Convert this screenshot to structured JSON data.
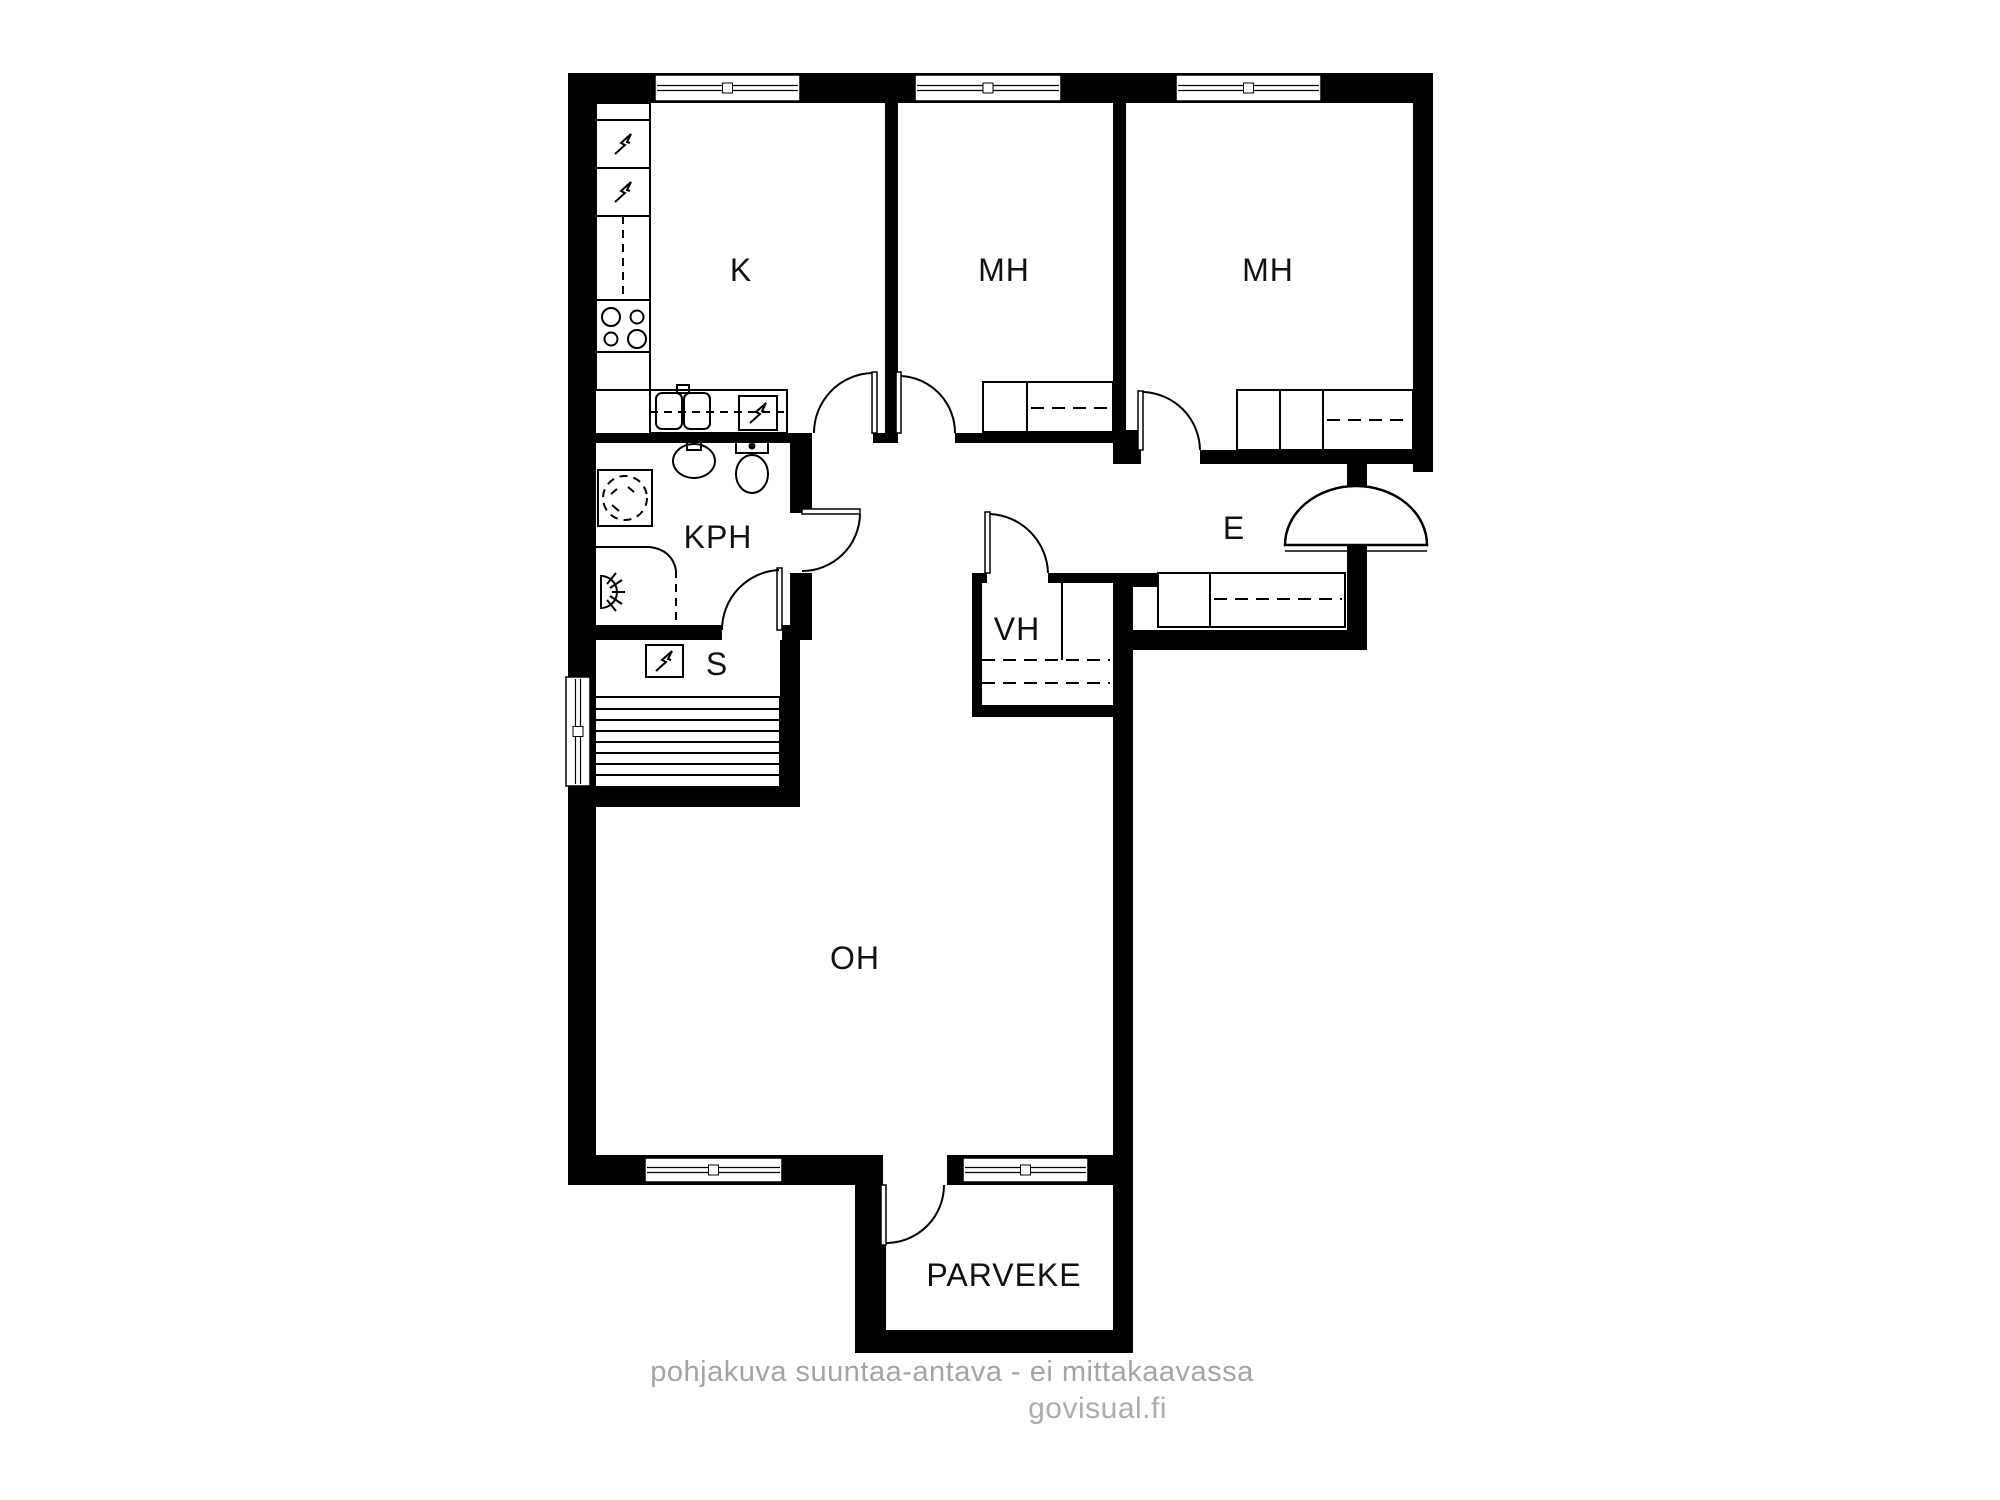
{
  "watermark": {
    "disclaimer": "pohjakuva suuntaa-antava - ei mittakaavassa",
    "credit": "govisual.fi"
  },
  "colors": {
    "background": "#ffffff",
    "wall": "#000000",
    "line": "#000000",
    "label": "#111111",
    "watermark": "#a6a6a6"
  },
  "room_labels": [
    {
      "id": "kitchen",
      "text": "K",
      "x": 741,
      "y": 270
    },
    {
      "id": "bedroom-1",
      "text": "MH",
      "x": 1004,
      "y": 270
    },
    {
      "id": "bedroom-2",
      "text": "MH",
      "x": 1268,
      "y": 270
    },
    {
      "id": "bathroom",
      "text": "KPH",
      "x": 718,
      "y": 537
    },
    {
      "id": "sauna",
      "text": "S",
      "x": 717,
      "y": 664
    },
    {
      "id": "closet",
      "text": "VH",
      "x": 1017,
      "y": 629
    },
    {
      "id": "entry",
      "text": "E",
      "x": 1234,
      "y": 528
    },
    {
      "id": "living-room",
      "text": "OH",
      "x": 855,
      "y": 958
    },
    {
      "id": "balcony",
      "text": "PARVEKE",
      "x": 1004,
      "y": 1275
    }
  ],
  "plan": {
    "walls": [
      {
        "n": "wall-top",
        "x": 568,
        "y": 73,
        "w": 865,
        "h": 30
      },
      {
        "n": "wall-left",
        "x": 568,
        "y": 73,
        "w": 28,
        "h": 1112
      },
      {
        "n": "wall-right-upper",
        "x": 1413,
        "y": 73,
        "w": 20,
        "h": 399
      },
      {
        "n": "wall-k-mh1",
        "x": 885,
        "y": 103,
        "w": 13,
        "h": 340
      },
      {
        "n": "wall-mh1-mh2",
        "x": 1113,
        "y": 103,
        "w": 13,
        "h": 330
      },
      {
        "n": "wall-mh1-mh2-base",
        "x": 1113,
        "y": 430,
        "w": 28,
        "h": 34
      },
      {
        "n": "wall-k-bottom",
        "x": 590,
        "y": 433,
        "w": 222,
        "h": 10
      },
      {
        "n": "wall-door-pier",
        "x": 873,
        "y": 433,
        "w": 25,
        "h": 10
      },
      {
        "n": "wall-mh1-bottom",
        "x": 955,
        "y": 433,
        "w": 158,
        "h": 10
      },
      {
        "n": "wall-mh2-bottom-left",
        "x": 1133,
        "y": 450,
        "w": 8,
        "h": 14
      },
      {
        "n": "wall-mh2-bottom",
        "x": 1200,
        "y": 450,
        "w": 213,
        "h": 14
      },
      {
        "n": "wall-entry-stub-upper",
        "x": 1347,
        "y": 464,
        "w": 20,
        "h": 23
      },
      {
        "n": "wall-entry-stub-lower",
        "x": 1347,
        "y": 549,
        "w": 20,
        "h": 101
      },
      {
        "n": "wall-entry-bottom",
        "x": 1133,
        "y": 630,
        "w": 234,
        "h": 20
      },
      {
        "n": "wall-entry-left-stub",
        "x": 1133,
        "y": 573,
        "w": 25,
        "h": 14
      },
      {
        "n": "wall-vh-top-left",
        "x": 972,
        "y": 573,
        "w": 15,
        "h": 10
      },
      {
        "n": "wall-vh-top-right",
        "x": 1048,
        "y": 573,
        "w": 85,
        "h": 10
      },
      {
        "n": "wall-vh-left",
        "x": 972,
        "y": 573,
        "w": 10,
        "h": 144
      },
      {
        "n": "wall-vh-bottom",
        "x": 972,
        "y": 705,
        "w": 161,
        "h": 12
      },
      {
        "n": "wall-oh-right",
        "x": 1113,
        "y": 573,
        "w": 20,
        "h": 780
      },
      {
        "n": "wall-kph-right-upper",
        "x": 790,
        "y": 443,
        "w": 22,
        "h": 70
      },
      {
        "n": "wall-kph-right-lower",
        "x": 790,
        "y": 573,
        "w": 22,
        "h": 67
      },
      {
        "n": "wall-kph-bottom-left",
        "x": 590,
        "y": 625,
        "w": 132,
        "h": 15
      },
      {
        "n": "wall-kph-bottom-right",
        "x": 782,
        "y": 625,
        "w": 30,
        "h": 15
      },
      {
        "n": "wall-sauna-right",
        "x": 780,
        "y": 640,
        "w": 20,
        "h": 147
      },
      {
        "n": "wall-sauna-bottom",
        "x": 568,
        "y": 787,
        "w": 232,
        "h": 20
      },
      {
        "n": "wall-oh-bottom",
        "x": 568,
        "y": 1155,
        "w": 565,
        "h": 30
      },
      {
        "n": "wall-balcony-left",
        "x": 855,
        "y": 1185,
        "w": 31,
        "h": 168
      },
      {
        "n": "wall-balcony-bottom",
        "x": 855,
        "y": 1330,
        "w": 278,
        "h": 23
      }
    ],
    "openings": [
      {
        "n": "balcony-door-opening",
        "x": 883,
        "y": 1155,
        "w": 64,
        "h": 31
      }
    ],
    "windows_h": [
      {
        "n": "window-kitchen",
        "x": 655,
        "y": 75,
        "w": 145,
        "h": 26
      },
      {
        "n": "window-bedroom-1",
        "x": 915,
        "y": 75,
        "w": 146,
        "h": 26
      },
      {
        "n": "window-bedroom-2",
        "x": 1176,
        "y": 75,
        "w": 145,
        "h": 26
      },
      {
        "n": "window-living-left",
        "x": 645,
        "y": 1158,
        "w": 137,
        "h": 24
      },
      {
        "n": "window-living-right",
        "x": 963,
        "y": 1158,
        "w": 125,
        "h": 24
      }
    ],
    "windows_v": [
      {
        "n": "window-sauna",
        "x": 566,
        "y": 677,
        "w": 24,
        "h": 109
      }
    ],
    "doors": [
      {
        "n": "door-kitchen",
        "leaf": [
          872,
          372,
          5,
          61
        ],
        "arc": "M 814 433 A 60 60 0 0 1 872 373"
      },
      {
        "n": "door-bedroom-1",
        "leaf": [
          896,
          372,
          5,
          61
        ],
        "arc": "M 955 433 A 57 57 0 0 0 901 376"
      },
      {
        "n": "door-bedroom-2",
        "leaf": [
          1138,
          391,
          5,
          59
        ],
        "arc": "M 1200 450 A 59 59 0 0 0 1143 392"
      },
      {
        "n": "door-bathroom",
        "leaf": [
          802,
          509,
          58,
          5
        ],
        "arc": "M 860 514 A 58 58 0 0 1 802 571"
      },
      {
        "n": "door-sauna",
        "leaf": [
          777,
          568,
          5,
          62
        ],
        "arc": "M 722 630 A 60 60 0 0 1 779 570"
      },
      {
        "n": "door-closet",
        "leaf": [
          985,
          512,
          5,
          61
        ],
        "arc": "M 1048 573 A 61 61 0 0 0 990 514"
      },
      {
        "n": "door-balcony",
        "leaf": [
          881,
          1185,
          5,
          60
        ],
        "arc": "M 944 1185 A 58 58 0 0 1 886 1243"
      }
    ],
    "entrance_door": {
      "n": "entrance-door",
      "dome": "M 1285 545 A 71 59 0 0 1 1427 545 Z",
      "threshold": [
        1285,
        551,
        1427,
        551
      ],
      "notch": [
        1347,
        545,
        20,
        7
      ]
    },
    "wardrobes": [
      {
        "n": "wardrobe-bedroom-1",
        "box": [
          983,
          382,
          130,
          50
        ],
        "lines": [
          [
            1027,
            382,
            1027,
            432
          ]
        ],
        "dashes": [
          [
            1031,
            408,
            1110,
            408
          ]
        ]
      },
      {
        "n": "wardrobe-bedroom-2",
        "box": [
          1237,
          390,
          176,
          60
        ],
        "lines": [
          [
            1280,
            390,
            1280,
            450
          ],
          [
            1323,
            390,
            1323,
            450
          ]
        ],
        "dashes": [
          [
            1327,
            420,
            1410,
            420
          ]
        ]
      },
      {
        "n": "wardrobe-entry",
        "box": [
          1158,
          573,
          187,
          54
        ],
        "lines": [
          [
            1210,
            573,
            1210,
            627
          ]
        ],
        "dashes": [
          [
            1214,
            599,
            1342,
            599
          ]
        ]
      },
      {
        "n": "shelves-closet",
        "box": null,
        "lines": [
          [
            1062,
            583,
            1062,
            660
          ]
        ],
        "dashes": [
          [
            982,
            660,
            1110,
            660
          ],
          [
            982,
            683,
            1110,
            683
          ]
        ]
      }
    ],
    "fixtures": [
      {
        "n": "kitchen-tall-unit",
        "t": "r",
        "x": 596,
        "y": 103,
        "w": 54,
        "h": 287
      },
      {
        "n": "kitchen-unit-line",
        "t": "l",
        "x1": 596,
        "y1": 120,
        "x2": 650,
        "y2": 120
      },
      {
        "n": "kitchen-unit-line",
        "t": "l",
        "x1": 596,
        "y1": 168,
        "x2": 650,
        "y2": 168
      },
      {
        "n": "kitchen-unit-line",
        "t": "l",
        "x1": 596,
        "y1": 216,
        "x2": 650,
        "y2": 216
      },
      {
        "n": "kitchen-unit-line",
        "t": "l",
        "x1": 596,
        "y1": 300,
        "x2": 650,
        "y2": 300
      },
      {
        "n": "kitchen-unit-line",
        "t": "l",
        "x1": 596,
        "y1": 352,
        "x2": 650,
        "y2": 352
      },
      {
        "n": "kitchen-cabinet-dash",
        "t": "l",
        "x1": 623,
        "y1": 216,
        "x2": 623,
        "y2": 300,
        "d": 1
      },
      {
        "n": "fridge-icon",
        "t": "b",
        "x": 623,
        "y": 144
      },
      {
        "n": "freezer-icon",
        "t": "b",
        "x": 623,
        "y": 192
      },
      {
        "n": "stove-burner",
        "t": "e",
        "cx": 611,
        "cy": 317,
        "rx": 9,
        "ry": 9
      },
      {
        "n": "stove-burner",
        "t": "e",
        "cx": 637,
        "cy": 317,
        "rx": 6.5,
        "ry": 6.5
      },
      {
        "n": "stove-burner",
        "t": "e",
        "cx": 611,
        "cy": 339,
        "rx": 6.5,
        "ry": 6.5
      },
      {
        "n": "stove-burner",
        "t": "e",
        "cx": 637,
        "cy": 339,
        "rx": 9,
        "ry": 9
      },
      {
        "n": "kitchen-counter",
        "t": "r",
        "x": 650,
        "y": 390,
        "w": 137,
        "h": 43
      },
      {
        "n": "kitchen-counter-dash",
        "t": "l",
        "x1": 650,
        "y1": 412,
        "x2": 787,
        "y2": 412,
        "d": 1
      },
      {
        "n": "sink-basin",
        "t": "r",
        "x": 656,
        "y": 393,
        "w": 26,
        "h": 36,
        "rx": 6
      },
      {
        "n": "sink-basin",
        "t": "r",
        "x": 684,
        "y": 393,
        "w": 26,
        "h": 36,
        "rx": 6
      },
      {
        "n": "sink-faucet",
        "t": "r",
        "x": 677,
        "y": 385,
        "w": 12,
        "h": 8
      },
      {
        "n": "dishwasher-box",
        "t": "r",
        "x": 739,
        "y": 396,
        "w": 38,
        "h": 34
      },
      {
        "n": "dishwasher-icon",
        "t": "b",
        "x": 758,
        "y": 413
      },
      {
        "n": "washing-machine-box",
        "t": "r",
        "x": 598,
        "y": 470,
        "w": 54,
        "h": 56
      },
      {
        "n": "washing-machine-circle",
        "t": "e",
        "cx": 625,
        "cy": 498,
        "rx": 22,
        "ry": 22,
        "d": 1
      },
      {
        "n": "washer-mark",
        "t": "l",
        "x1": 612,
        "y1": 505,
        "x2": 619,
        "y2": 511
      },
      {
        "n": "washer-mark",
        "t": "l",
        "x1": 628,
        "y1": 487,
        "x2": 634,
        "y2": 492
      },
      {
        "n": "washer-mark",
        "t": "l",
        "x1": 617,
        "y1": 489,
        "x2": 611,
        "y2": 494
      },
      {
        "n": "bathroom-sink",
        "t": "e",
        "cx": 694,
        "cy": 461,
        "rx": 21,
        "ry": 17
      },
      {
        "n": "bathroom-faucet",
        "t": "r",
        "x": 687,
        "y": 441,
        "w": 14,
        "h": 9
      },
      {
        "n": "toilet-tank",
        "t": "r",
        "x": 736,
        "y": 440,
        "w": 32,
        "h": 13
      },
      {
        "n": "toilet-bowl",
        "t": "e",
        "cx": 752,
        "cy": 474,
        "rx": 16,
        "ry": 19
      },
      {
        "n": "toilet-button",
        "t": "e",
        "cx": 752,
        "cy": 446,
        "rx": 2.5,
        "ry": 2.5,
        "f": 1
      },
      {
        "n": "shower-screen",
        "t": "l",
        "x1": 568,
        "y1": 547,
        "x2": 650,
        "y2": 547
      },
      {
        "n": "shower-screen-curve",
        "t": "p",
        "dd": "M 650 547 Q 672 550 676 570"
      },
      {
        "n": "shower-screen-dash",
        "t": "l",
        "x1": 676,
        "y1": 570,
        "x2": 676,
        "y2": 624,
        "d": 1
      },
      {
        "n": "shower-head-icon",
        "t": "p",
        "dd": "M 601 576 A 16 16 0 0 1 601 608 Z"
      },
      {
        "n": "shower-ray",
        "t": "l",
        "x1": 607,
        "y1": 584,
        "x2": 616,
        "y2": 573
      },
      {
        "n": "shower-ray",
        "t": "l",
        "x1": 610,
        "y1": 588,
        "x2": 622,
        "y2": 580
      },
      {
        "n": "shower-ray",
        "t": "l",
        "x1": 612,
        "y1": 592,
        "x2": 625,
        "y2": 592
      },
      {
        "n": "shower-ray",
        "t": "l",
        "x1": 610,
        "y1": 596,
        "x2": 622,
        "y2": 604
      },
      {
        "n": "shower-ray",
        "t": "l",
        "x1": 607,
        "y1": 600,
        "x2": 616,
        "y2": 611
      },
      {
        "n": "sauna-heater-box",
        "t": "r",
        "x": 646,
        "y": 645,
        "w": 37,
        "h": 32
      },
      {
        "n": "sauna-heater-icon",
        "t": "b",
        "x": 664,
        "y": 661
      },
      {
        "n": "sauna-benches",
        "t": "r",
        "x": 594,
        "y": 697,
        "w": 186,
        "h": 90
      },
      {
        "n": "sauna-bench-slat",
        "t": "l",
        "x1": 594,
        "y1": 709,
        "x2": 780,
        "y2": 709
      },
      {
        "n": "sauna-bench-slat",
        "t": "l",
        "x1": 594,
        "y1": 720,
        "x2": 780,
        "y2": 720
      },
      {
        "n": "sauna-bench-slat",
        "t": "l",
        "x1": 594,
        "y1": 731,
        "x2": 780,
        "y2": 731
      },
      {
        "n": "sauna-bench-slat",
        "t": "l",
        "x1": 594,
        "y1": 742,
        "x2": 780,
        "y2": 742
      },
      {
        "n": "sauna-bench-slat",
        "t": "l",
        "x1": 594,
        "y1": 753,
        "x2": 780,
        "y2": 753
      },
      {
        "n": "sauna-bench-slat",
        "t": "l",
        "x1": 594,
        "y1": 764,
        "x2": 780,
        "y2": 764
      },
      {
        "n": "sauna-bench-slat",
        "t": "l",
        "x1": 594,
        "y1": 775,
        "x2": 780,
        "y2": 775
      }
    ]
  }
}
